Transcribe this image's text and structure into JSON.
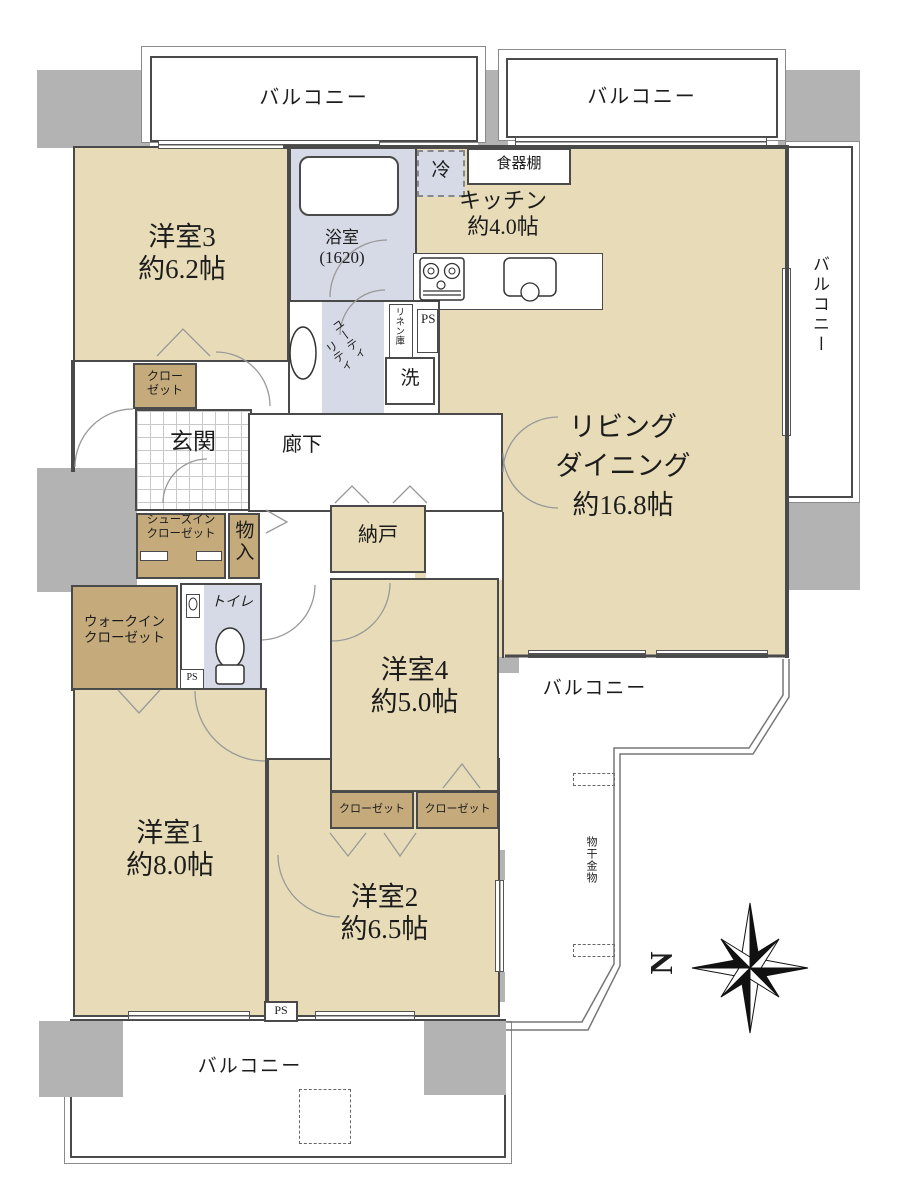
{
  "colors": {
    "floor_beige": "#e8dcb8",
    "closet_brown": "#c5ab7c",
    "wet_area_blue": "#d6dae6",
    "wall_gray": "#b3b3b3",
    "line_dark": "#4a4a4a"
  },
  "balcony": {
    "label": "バルコニー"
  },
  "rooms": {
    "western3": {
      "name": "洋室3",
      "area": "約6.2帖"
    },
    "western4": {
      "name": "洋室4",
      "area": "約5.0帖"
    },
    "western1": {
      "name": "洋室1",
      "area": "約8.0帖"
    },
    "western2": {
      "name": "洋室2",
      "area": "約6.5帖"
    },
    "living_dining": {
      "line1": "リビング",
      "line2": "ダイニング",
      "area": "約16.8帖"
    },
    "kitchen": {
      "name": "キッチン",
      "area": "約4.0帖"
    },
    "bathroom": {
      "name": "浴室",
      "size": "(1620)"
    },
    "entrance": {
      "name": "玄関"
    },
    "hallway": {
      "name": "廊下"
    },
    "storeroom": {
      "name": "納戸"
    },
    "toilet": {
      "name": "トイレ"
    }
  },
  "closets": {
    "closet_word": "クローゼット",
    "closet_line1": "クロー",
    "closet_line2": "ゼット",
    "walk_in_line1": "ウォークイン",
    "walk_in_line2": "クローゼット",
    "shoes_in_line1": "シューズイン",
    "shoes_in_line2": "クローゼット",
    "storage_compartment": "物入"
  },
  "utility": {
    "part1": "ユーティ",
    "part2": "リティ",
    "linen": "リネン庫",
    "washer": "洗"
  },
  "kitchen_items": {
    "refrigerator": "冷",
    "cupboard": "食器棚"
  },
  "misc": {
    "ps": "PS",
    "laundry_hardware": "物干金物",
    "north": "N"
  }
}
